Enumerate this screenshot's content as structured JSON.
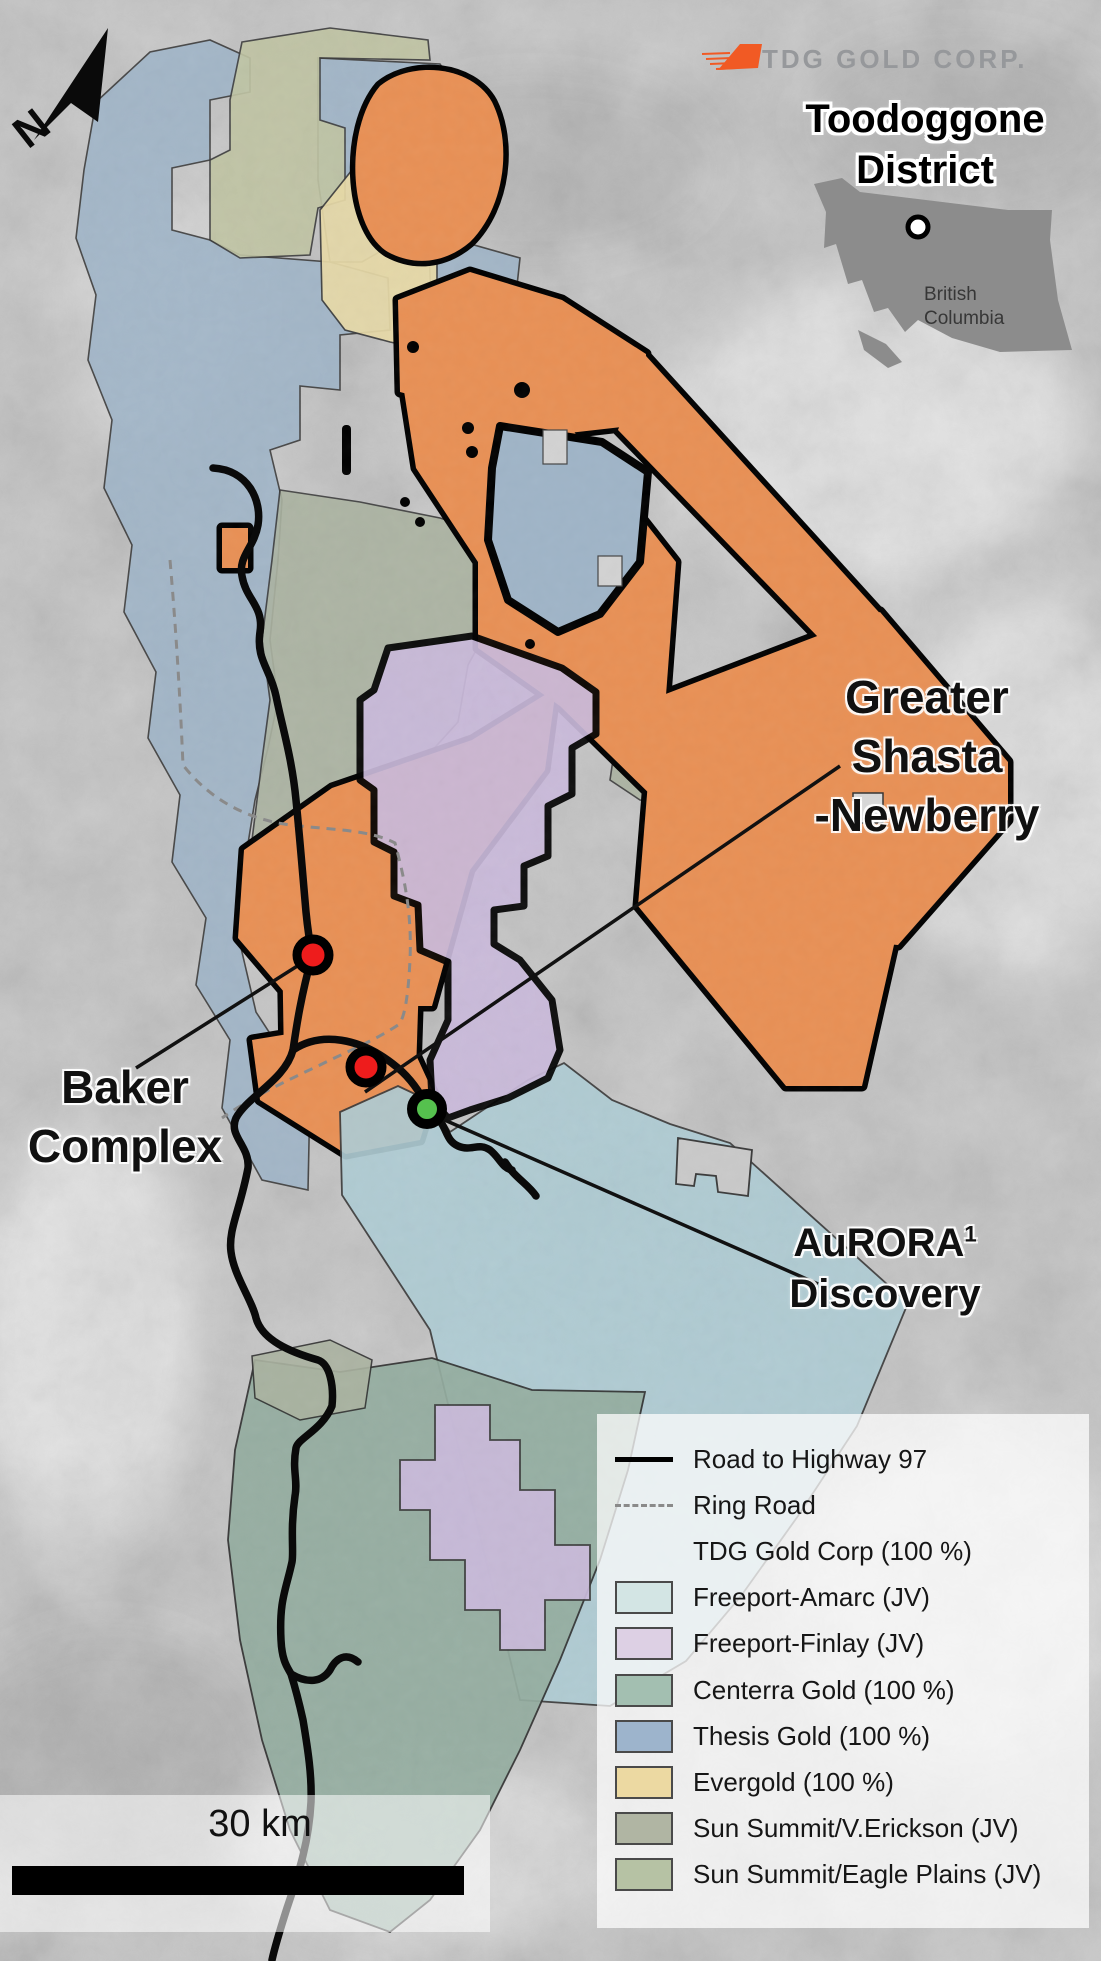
{
  "logo": {
    "text": "TDG GOLD CORP."
  },
  "inset": {
    "title_line1": "Toodoggone",
    "title_line2": "District",
    "province_line1": "British",
    "province_line2": "Columbia"
  },
  "north": {
    "label": "N"
  },
  "map_labels": {
    "greater_shasta_line1": "Greater",
    "greater_shasta_line2": "Shasta",
    "greater_shasta_line3": "-Newberry",
    "baker_line1": "Baker",
    "baker_line2": "Complex",
    "aurora_name": "AuRORA",
    "aurora_superscript": "1",
    "aurora_line2": "Discovery"
  },
  "scale_bar": {
    "label": "30 km"
  },
  "legend": {
    "items": [
      {
        "type": "line-solid",
        "label": "Road to Highway 97"
      },
      {
        "type": "line-dashed",
        "label": "Ring Road"
      },
      {
        "type": "none",
        "label": "TDG Gold Corp (100 %)"
      },
      {
        "type": "swatch",
        "color": "#d3e5e4",
        "label": "Freeport-Amarc (JV)"
      },
      {
        "type": "swatch",
        "color": "#ddd0e4",
        "label": "Freeport-Finlay (JV)"
      },
      {
        "type": "swatch",
        "color": "#a3bfb1",
        "label": "Centerra Gold (100 %)"
      },
      {
        "type": "swatch",
        "color": "#9db4cc",
        "label": "Thesis Gold (100 %)"
      },
      {
        "type": "swatch",
        "color": "#ecd9a2",
        "label": "Evergold (100 %)"
      },
      {
        "type": "swatch",
        "color": "#b0b5a3",
        "label": "Sun Summit/V.Erickson (JV)"
      },
      {
        "type": "swatch",
        "color": "#b6c2a4",
        "label": "Sun Summit/Eagle Plains (JV)"
      }
    ]
  },
  "colors": {
    "tdg_orange": "#e89055",
    "thesis_blue": "#9fb4c7",
    "amarc_blue": "#aecbd3",
    "finlay_purple": "#c9b9da",
    "centerra_green": "#93ac9f",
    "evergold_yellow": "#e7d9a6",
    "erickson_sage": "#aab2a0",
    "eagle_plains_olive": "#bfc3a2",
    "logo_orange": "#f15a24",
    "marker_red": "#ee1c1c",
    "marker_green": "#55c14e",
    "bc_gray": "#8c8c8c"
  }
}
